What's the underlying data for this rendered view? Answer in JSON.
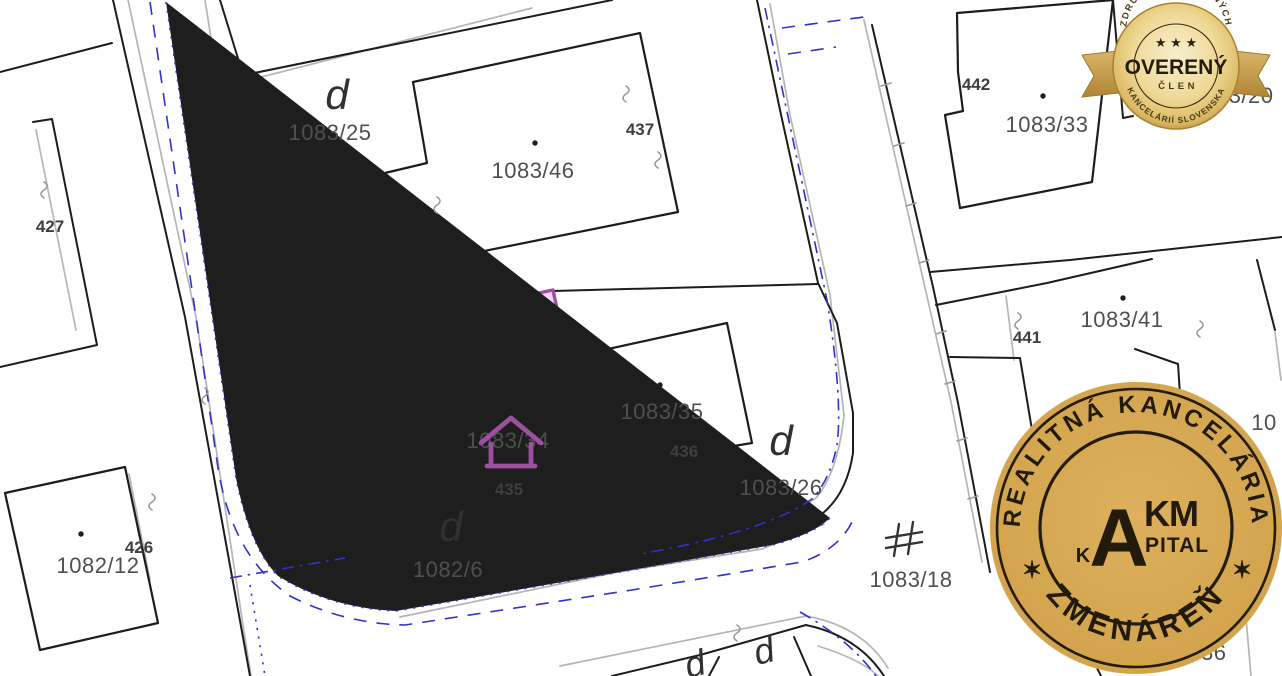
{
  "theme": {
    "highlight-fill": "#eed7f0",
    "highlight-stroke": "#9d4fa1",
    "boundary": "#1c1c1c",
    "road-gray": "#b5b5b5",
    "utility-blue": "#3032c8",
    "label-color": "#4f4f4f",
    "label-bold-color": "#3e3e3e",
    "badge-gold": "#d9b25f",
    "stamp-gold": "#d6a74f",
    "stamp-ink": "#221a0b"
  },
  "map": {
    "highlighted_parcels": [
      "1082/6",
      "1083/34"
    ],
    "labels": [
      {
        "text": "d",
        "x": 337,
        "y": 95,
        "style": "letter"
      },
      {
        "text": "1083/25",
        "x": 330,
        "y": 133,
        "style": "parcel"
      },
      {
        "text": "1083/46",
        "x": 533,
        "y": 171,
        "style": "parcel"
      },
      {
        "text": "437",
        "x": 640,
        "y": 130,
        "style": "parcel-bold"
      },
      {
        "text": "427",
        "x": 50,
        "y": 227,
        "style": "parcel-bold"
      },
      {
        "text": "442",
        "x": 976,
        "y": 85,
        "style": "parcel-bold"
      },
      {
        "text": "1083/33",
        "x": 1047,
        "y": 125,
        "style": "parcel"
      },
      {
        "text": "1083/20",
        "x": 1232,
        "y": 96,
        "style": "parcel"
      },
      {
        "text": "441",
        "x": 1027,
        "y": 338,
        "style": "parcel-bold"
      },
      {
        "text": "1083/41",
        "x": 1122,
        "y": 320,
        "style": "parcel"
      },
      {
        "text": "1083/35",
        "x": 662,
        "y": 412,
        "style": "parcel"
      },
      {
        "text": "436",
        "x": 684,
        "y": 452,
        "style": "parcel-bold"
      },
      {
        "text": "d",
        "x": 781,
        "y": 441,
        "style": "letter"
      },
      {
        "text": "1083/26",
        "x": 781,
        "y": 488,
        "style": "parcel"
      },
      {
        "text": "1083/34",
        "x": 508,
        "y": 441,
        "style": "parcel"
      },
      {
        "text": "435",
        "x": 509,
        "y": 490,
        "style": "parcel-bold"
      },
      {
        "text": "d",
        "x": 451,
        "y": 527,
        "style": "letter"
      },
      {
        "text": "1082/6",
        "x": 448,
        "y": 570,
        "style": "parcel"
      },
      {
        "text": "1082/12",
        "x": 98,
        "y": 566,
        "style": "parcel"
      },
      {
        "text": "426",
        "x": 139,
        "y": 548,
        "style": "parcel-bold"
      },
      {
        "text": "1083/18",
        "x": 911,
        "y": 580,
        "style": "parcel"
      },
      {
        "text": "1083/36",
        "x": 1185,
        "y": 653,
        "style": "parcel"
      },
      {
        "text": "10",
        "x": 1264,
        "y": 423,
        "style": "parcel"
      },
      {
        "text": "d",
        "x": 695,
        "y": 664,
        "style": "letter-small"
      },
      {
        "text": "d",
        "x": 764,
        "y": 651,
        "style": "letter-small"
      }
    ]
  },
  "badge": {
    "arc_top": "ZDRUŽENIE REALITNÝCH",
    "stars": "★ ★ ★",
    "title": "OVERENÝ",
    "subtitle": "ČLEN",
    "arc_bottom": "KANCELÁRIÍ SLOVENSKA"
  },
  "stamp": {
    "arc_top": "REALITNÁ KANCELÁRIA",
    "arc_bottom": "ZMENÁREŇ",
    "star_left": "✶",
    "star_right": "✶",
    "logo": {
      "k": "K",
      "a": "A",
      "km": "KM",
      "pital": "PITAL"
    }
  }
}
